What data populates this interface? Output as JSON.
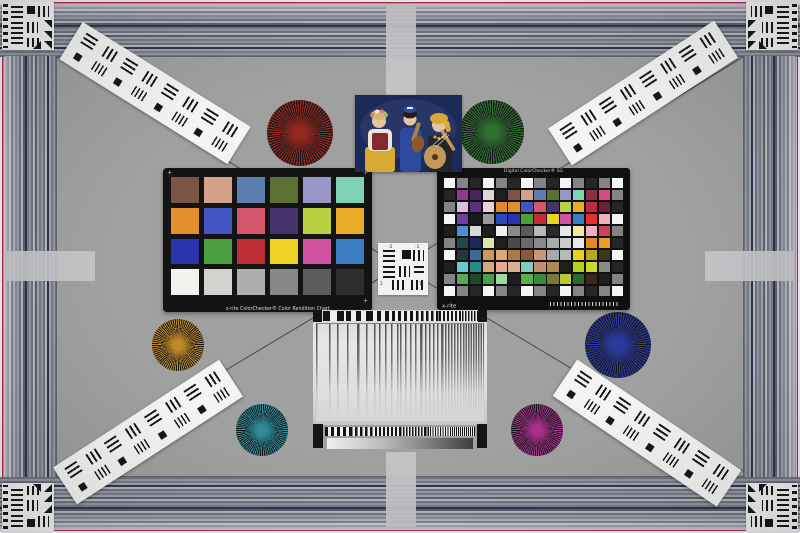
{
  "scene": {
    "name": "camera-resolution-color-test-chart",
    "width": 800,
    "height": 533
  },
  "palette": {
    "background": "#9c9c9c",
    "field": "#a0a0a0",
    "tab": "#c6c6c9",
    "edge_red": "#a83048",
    "band_navy": "#343450",
    "chart_black": "#141414",
    "strip_white": "#f4f4f2",
    "photo_bg": "#1c2a58",
    "photo_skin": "#e6c49e",
    "photo_blonde": "#d8b868",
    "photo_red": "#8a2832",
    "photo_blue": "#2d4b9e",
    "photo_yellow": "#d8aa34",
    "photo_wood": "#b08048",
    "photo_dark": "#22262c",
    "photo_white": "#eae6da"
  },
  "texts": {
    "classic_caption": "x-rite ColorChecker® Color Rendition Chart",
    "sg_title": "Digital ColorChecker® SG",
    "sg_logo": "x-rite",
    "center_labels": [
      "-2",
      "-1",
      "2",
      "1"
    ]
  },
  "colorchecker_classic": {
    "rows": 4,
    "cols": 6,
    "colors": [
      "#7a5444",
      "#d4a288",
      "#5c7fb0",
      "#5c7034",
      "#9995c9",
      "#7ed2b8",
      "#e2902c",
      "#4355c2",
      "#d4566b",
      "#46336e",
      "#b9d244",
      "#eaad28",
      "#2a35ad",
      "#4aa03f",
      "#bf2e35",
      "#eed223",
      "#d253a3",
      "#3b7ec2",
      "#f2f2ef",
      "#d2d2cf",
      "#aeaeac",
      "#878785",
      "#5c5c5c",
      "#2e2e2e"
    ]
  },
  "colorchecker_sg": {
    "rows": 10,
    "cols": 14,
    "colors": [
      "#f4f4f4",
      "#848484",
      "#262626",
      "#f4f4f4",
      "#848484",
      "#262626",
      "#f4f4f4",
      "#848484",
      "#262626",
      "#f4f4f4",
      "#848484",
      "#262626",
      "#848484",
      "#f4f4f4",
      "#262626",
      "#8e3a8e",
      "#46275c",
      "#dcd8d4",
      "#1e1e1e",
      "#7a5444",
      "#d4a288",
      "#5c7fb0",
      "#5c7034",
      "#9995c9",
      "#7ed2b8",
      "#8c2e44",
      "#d84a84",
      "#848484",
      "#848484",
      "#d8c0dc",
      "#5a3280",
      "#ecd0d8",
      "#e08830",
      "#e2902c",
      "#4355c2",
      "#d4566b",
      "#46336e",
      "#b9d244",
      "#eaad28",
      "#c22840",
      "#6e1e3a",
      "#262626",
      "#f4f4f4",
      "#7040a0",
      "#1a1a1a",
      "#9a9a9a",
      "#2a4ab8",
      "#2a35ad",
      "#4aa03f",
      "#bf2e35",
      "#eed223",
      "#d253a3",
      "#3b7ec2",
      "#e23030",
      "#f0b0b8",
      "#f4f4f4",
      "#1e1e1e",
      "#4a90d8",
      "#d8d8d8",
      "#1e1e1e",
      "#f0f0f0",
      "#8a8a8a",
      "#5a5a5a",
      "#b8b8b8",
      "#2a2a2a",
      "#e8e8e8",
      "#f8e8a0",
      "#f0b0c0",
      "#d04058",
      "#848484",
      "#848484",
      "#1e4a4a",
      "#1a2a5a",
      "#d8e8a8",
      "#1e1e1e",
      "#4a4a4a",
      "#6a6a6a",
      "#8a8a8a",
      "#ababab",
      "#cbcbcb",
      "#e8e8e8",
      "#e88820",
      "#e8a020",
      "#262626",
      "#f4f4f4",
      "#1e3a3a",
      "#3a6a9a",
      "#d09858",
      "#d8a878",
      "#b07848",
      "#8a5a38",
      "#c89878",
      "#a8a8a8",
      "#b8b8b8",
      "#e8d020",
      "#b8a820",
      "#3a3a1a",
      "#f4f4f4",
      "#1e1e1e",
      "#68c8d8",
      "#2a8a8a",
      "#d8a878",
      "#e8a898",
      "#d8b090",
      "#88c8c0",
      "#c09070",
      "#b08858",
      "#1e1e1e",
      "#b8d020",
      "#c8d830",
      "#8a8a8a",
      "#262626",
      "#848484",
      "#58a858",
      "#1e4a2a",
      "#48a048",
      "#a0d8a0",
      "#1e1e1e",
      "#58b048",
      "#3a8a3a",
      "#787838",
      "#b8c838",
      "#2a6a2a",
      "#3a2a1a",
      "#1e1e1e",
      "#848484",
      "#f4f4f4",
      "#848484",
      "#262626",
      "#f4f4f4",
      "#848484",
      "#262626",
      "#f4f4f4",
      "#848484",
      "#262626",
      "#f4f4f4",
      "#848484",
      "#262626",
      "#848484",
      "#f4f4f4"
    ]
  },
  "siemens_stars": [
    {
      "name": "star-red",
      "x": 300,
      "y": 133,
      "r": 33,
      "color": "#93281e"
    },
    {
      "name": "star-green",
      "x": 492,
      "y": 132,
      "r": 32,
      "color": "#2f7030"
    },
    {
      "name": "star-gold",
      "x": 178,
      "y": 345,
      "r": 26,
      "color": "#bf8a28"
    },
    {
      "name": "star-blue",
      "x": 618,
      "y": 345,
      "r": 33,
      "color": "#2b3a9e"
    },
    {
      "name": "star-teal",
      "x": 262,
      "y": 430,
      "r": 26,
      "color": "#2f8d98"
    },
    {
      "name": "star-magenta",
      "x": 537,
      "y": 430,
      "r": 26,
      "color": "#a8308c"
    }
  ],
  "resolution_strips": [
    {
      "id": "strip-top-left",
      "cx": 155,
      "cy": 93,
      "angle": 32
    },
    {
      "id": "strip-top-right",
      "cx": 643,
      "cy": 93,
      "angle": -33
    },
    {
      "id": "strip-bottom-left",
      "cx": 148,
      "cy": 432,
      "angle": -33
    },
    {
      "id": "strip-bottom-right",
      "cx": 647,
      "cy": 433,
      "angle": 34
    }
  ],
  "corner_charts": [
    {
      "pos": "top-left",
      "x": 2,
      "y": 2
    },
    {
      "pos": "top-right",
      "x": 746,
      "y": 2
    },
    {
      "pos": "bottom-left",
      "x": 2,
      "y": 483
    },
    {
      "pos": "bottom-right",
      "x": 746,
      "y": 483
    }
  ],
  "sweep_chart": {
    "bar_pitches_px": [
      13,
      10,
      8,
      6,
      5,
      4,
      3,
      2.5
    ],
    "checker_pitches_px": [
      7,
      5,
      4,
      3,
      2.5,
      2,
      1.5
    ],
    "gradient": [
      "#f0f0ee",
      "#3e3e3c"
    ]
  },
  "diagonals": {
    "center_x": 400,
    "center_y": 266,
    "corners": [
      [
        57,
        57
      ],
      [
        743,
        57
      ],
      [
        57,
        471
      ],
      [
        743,
        471
      ]
    ],
    "color": "#4a4a52"
  }
}
